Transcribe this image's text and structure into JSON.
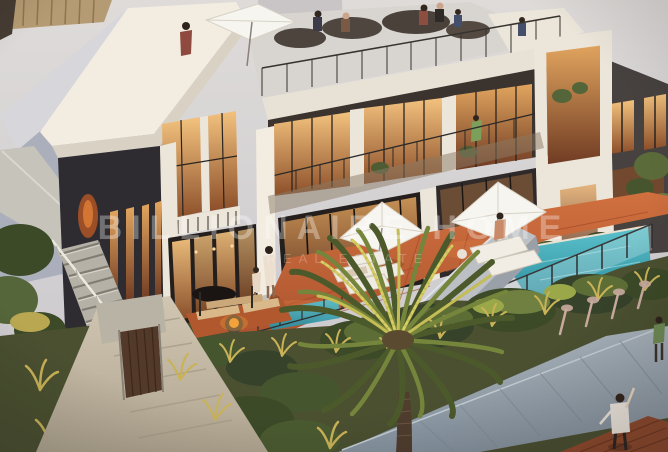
{
  "image": {
    "kind": "architectural render photograph",
    "description": "Aerial dusk render of modern two-storey townhouses with rooftop terrace party, lit interiors, terracotta patio, white umbrellas and loungers, swimming pool behind glass fence, exterior stair, palm tree and golden ornamental grasses",
    "width": 668,
    "height": 452
  },
  "watermark": {
    "line1": "BILLIONAIRE HOME",
    "line2": "REAL ESTATE"
  },
  "palette": {
    "watermark": "#ffffff",
    "sky_top": "#dedbd9",
    "sky_bottom": "#c9c6cc",
    "cream": "#ece6da",
    "cream_bright": "#f2ece1",
    "left_mass": "#abafbb",
    "fence_tan": "#b59b73",
    "dark_facade": "#47423f",
    "charcoal": "#2e2c31",
    "dark_frame": "#241f1c",
    "win_hi": "#f3c27e",
    "win_lo": "#8c4f2a",
    "patio_hi": "#d0703f",
    "patio_lo": "#a8502d",
    "pool_hi": "#5cc2cc",
    "pool_lo": "#2b8b9d",
    "gray_wall": "#bcc0c5",
    "umbrella": "#f7f5f0",
    "foliage_dark": "#3c4a28",
    "foliage_mid": "#5d6d36",
    "foliage_light": "#8fa047",
    "grass_gold": "#c9b257",
    "plume_pink": "#c9ab9e",
    "path_hi": "#d0c6b2",
    "path_lo": "#b0a590",
    "walk_hi": "#a8b2ba",
    "walk_lo": "#85929e",
    "deck": "#8f4a2c"
  }
}
